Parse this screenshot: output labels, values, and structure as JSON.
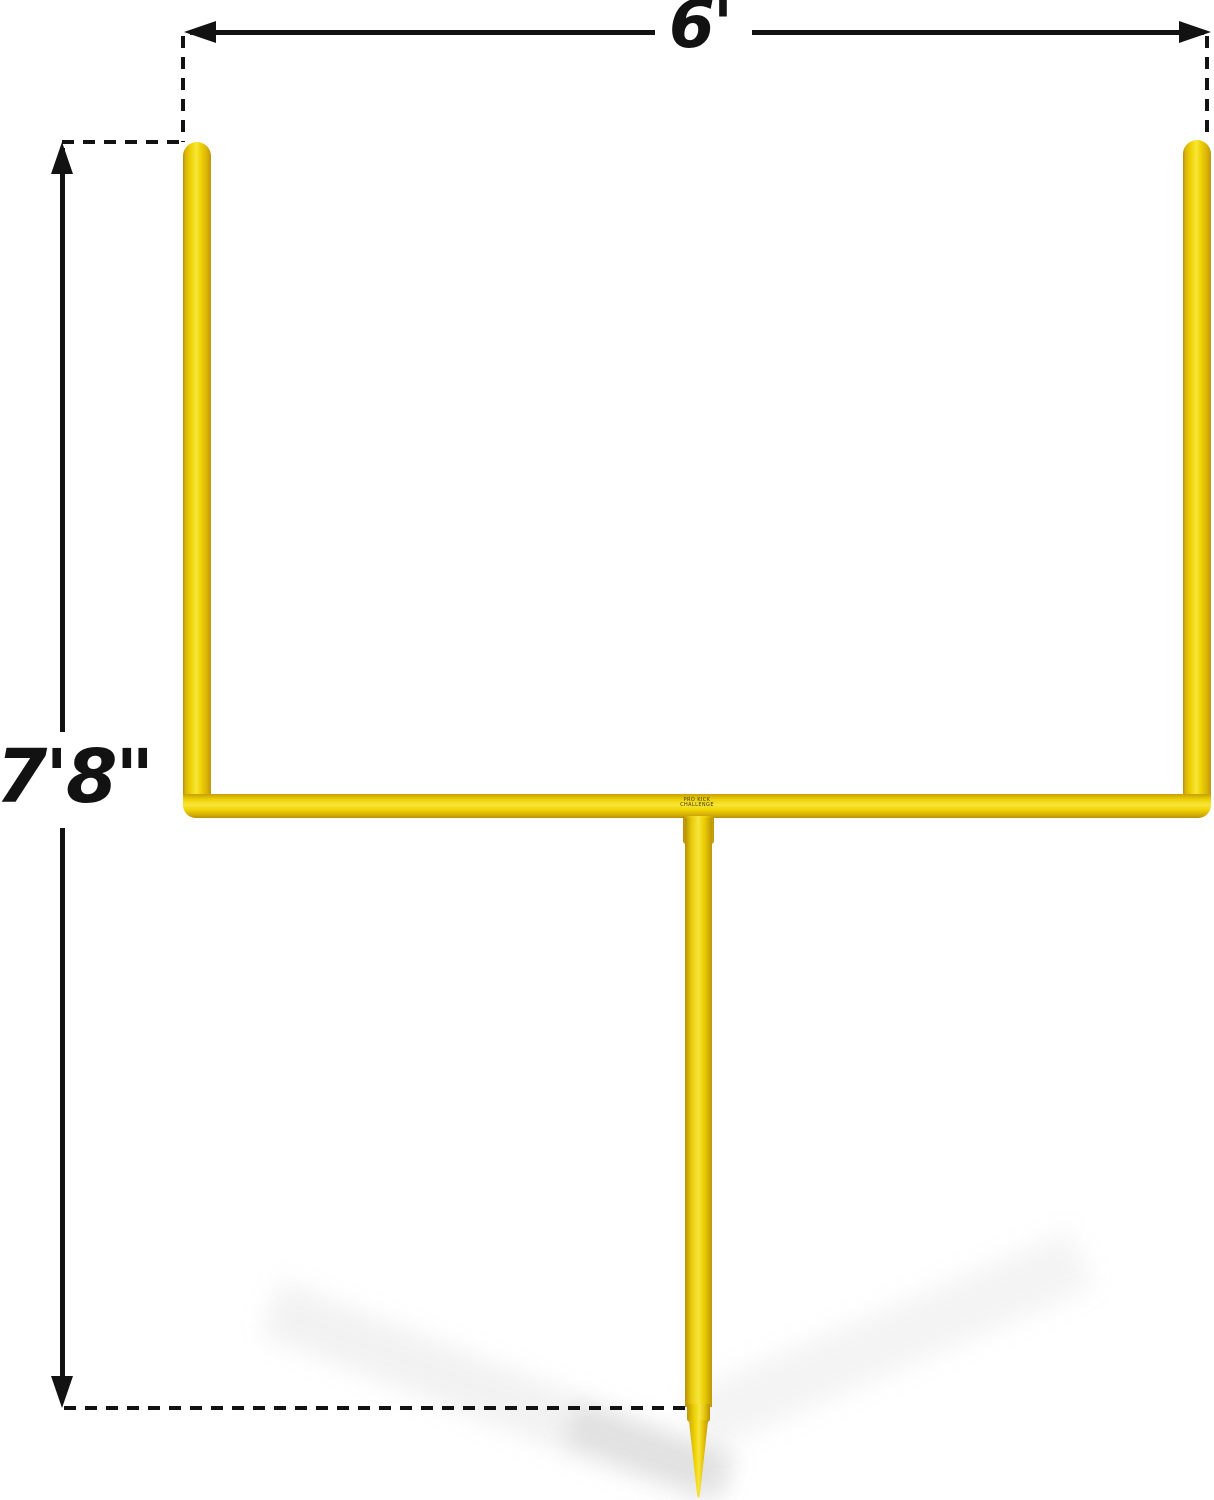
{
  "diagram": {
    "type": "product-dimension-diagram",
    "subject": "yellow football field goal post with ground spike",
    "background": "#ffffff",
    "width_dimension": {
      "label": "6'"
    },
    "height_dimension": {
      "label": "7'8\""
    },
    "crossbar_label": "PRO KICK CHALLENGE",
    "colors": {
      "dimension_line": "#121212",
      "post_yellow_mid": "#f0d404",
      "post_yellow_light": "#f7e53c",
      "post_yellow_dark": "#b68f05",
      "ground_shadow": "rgba(128,128,128,0.10)"
    }
  }
}
